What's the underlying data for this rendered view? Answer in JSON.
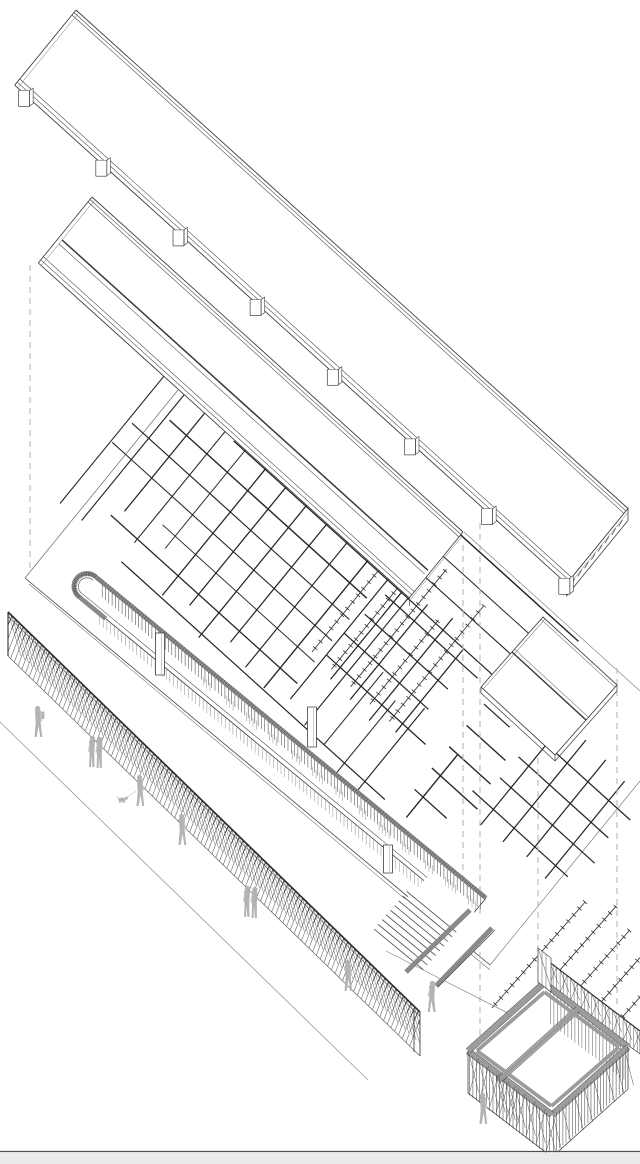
{
  "document": {
    "title": "Exploded axonometric architectural diagram",
    "type": "line drawing",
    "background": "#ffffff",
    "width_px": 640,
    "height_px": 1164
  },
  "palette": {
    "line_dark": "#3f3f3f",
    "line_medium": "#6b6b6b",
    "line_light": "#9a9a9a",
    "hatch_dark": "#262626",
    "rail_gray": "#8a8a8a",
    "beam_gray": "#9c9c9c",
    "slat_gray": "#4a4a4a",
    "figure_gray": "#b3b3b3",
    "figure_gray_light": "#c6c6c6",
    "dashed_guide": "#b5b5b5",
    "ground_strip_fill": "#ebebeb",
    "ground_strip_line": "#4f4f4f"
  },
  "layers": [
    {
      "id": "canopy-band-upper",
      "label": "upper roof canopy band",
      "support_feet": 8,
      "louvered_end": true
    },
    {
      "id": "canopy-band-lower",
      "label": "second roof canopy band",
      "support_feet": 0
    },
    {
      "id": "site-plate",
      "label": "site ground plate"
    },
    {
      "id": "canopy-crosshatch-field",
      "label": "large tree-canopy cross-hatch field",
      "spacing_px": 27.5
    },
    {
      "id": "small-grid-plate",
      "label": "small cross-hatch grid on plate",
      "lines_per_direction": 4,
      "spacing_px": 28
    },
    {
      "id": "small-grid-right",
      "label": "small cross-hatch grid in right column",
      "lines_per_direction": 4,
      "spacing_px": 28
    },
    {
      "id": "planting-rows-plate",
      "label": "ticked planting rows on plate",
      "rows": 5
    },
    {
      "id": "planting-rows-right",
      "label": "ticked planting rows in right column",
      "rows": 6
    },
    {
      "id": "pergola-walkway",
      "label": "curved pergola walkway with gray rail and balustrade",
      "columns": 3
    },
    {
      "id": "stair",
      "label": "stair at walkway end",
      "steps": 9
    },
    {
      "id": "screen-fence",
      "label": "woven screen fence along street"
    },
    {
      "id": "small-canopy",
      "label": "small ridged canopy"
    },
    {
      "id": "pavilion",
      "label": "open trellis pavilion",
      "bays": 2
    },
    {
      "id": "ground-strip",
      "label": "ground edge strip"
    }
  ],
  "projection_guides": [
    {
      "x": 30,
      "y1": 265,
      "y2": 572
    },
    {
      "x": 463,
      "y1": 545,
      "y2": 952
    },
    {
      "x": 480,
      "y1": 523,
      "y2": 1058
    },
    {
      "x": 538,
      "y1": 758,
      "y2": 985
    },
    {
      "x": 617,
      "y1": 668,
      "y2": 1004
    }
  ],
  "people": [
    {
      "kind": "walk",
      "face": "left",
      "backpack": true,
      "x": 38,
      "y": 738
    },
    {
      "kind": "stand",
      "pair": true,
      "x": 92,
      "y": 768
    },
    {
      "kind": "walk",
      "face": "left",
      "dog": {
        "x": 122,
        "y": 803
      },
      "x": 140,
      "y": 807
    },
    {
      "kind": "walk",
      "face": "left",
      "x": 182,
      "y": 846
    },
    {
      "kind": "stand",
      "pair": true,
      "x": 247,
      "y": 918
    },
    {
      "kind": "walk",
      "face": "left",
      "x": 348,
      "y": 992
    },
    {
      "kind": "walk",
      "face": "right",
      "x": 432,
      "y": 1013
    },
    {
      "kind": "walk",
      "face": "left",
      "x": 483,
      "y": 1125
    }
  ],
  "ground_strip": {
    "line_y": 1151.5,
    "fill_height": 12
  }
}
